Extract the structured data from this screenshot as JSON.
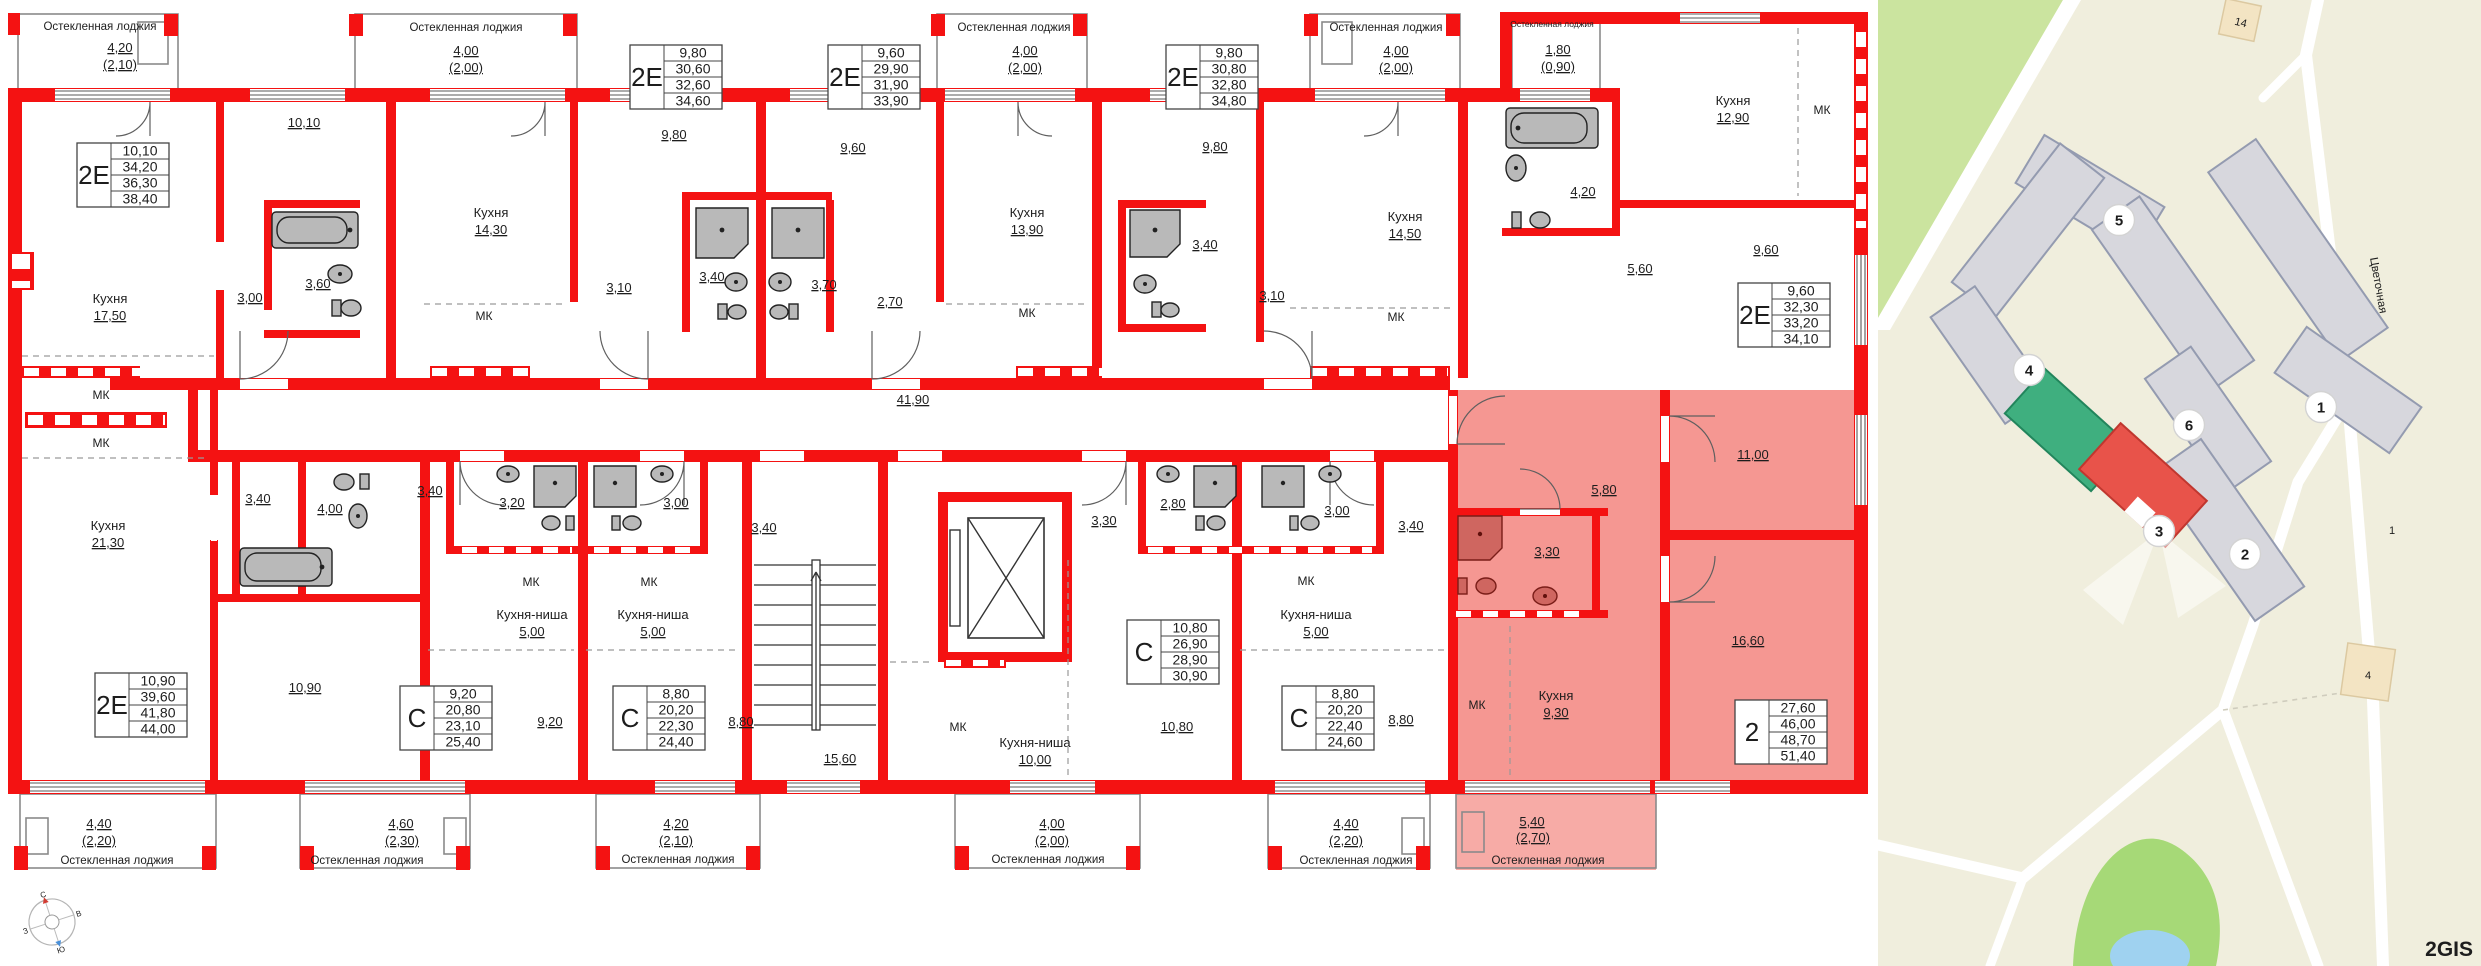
{
  "floor_plan": {
    "wall_color": "#f41212",
    "highlight_color": "#f59792",
    "corridor_area": "41,90",
    "labels": [
      [
        "Остекленная лоджия",
        100,
        30,
        11.5,
        ""
      ],
      [
        "4,20",
        120,
        52,
        13,
        "u"
      ],
      [
        "(2,10)",
        120,
        69,
        13,
        "u"
      ],
      [
        "Остекленная лоджия",
        466,
        31,
        11.5,
        ""
      ],
      [
        "4,00",
        466,
        55,
        13,
        "u"
      ],
      [
        "(2,00)",
        466,
        72,
        13,
        "u"
      ],
      [
        "Остекленная лоджия",
        1014,
        31,
        11.5,
        ""
      ],
      [
        "4,00",
        1025,
        55,
        13,
        "u"
      ],
      [
        "(2,00)",
        1025,
        72,
        13,
        "u"
      ],
      [
        "Остекленная лоджия",
        1386,
        31,
        11.5,
        ""
      ],
      [
        "4,00",
        1396,
        55,
        13,
        "u"
      ],
      [
        "(2,00)",
        1396,
        72,
        13,
        "u"
      ],
      [
        "Остекленная лоджия",
        1552,
        27,
        8.5,
        ""
      ],
      [
        "1,80",
        1558,
        54,
        13,
        "u"
      ],
      [
        "(0,90)",
        1558,
        71,
        13,
        "u"
      ],
      [
        "10,10",
        304,
        127,
        13,
        "u"
      ],
      [
        "Кухня",
        110,
        303,
        13,
        ""
      ],
      [
        "17,50",
        110,
        320,
        13,
        "u"
      ],
      [
        "3,00",
        250,
        302,
        13,
        "u"
      ],
      [
        "3,60",
        318,
        288,
        13,
        "u"
      ],
      [
        "9,80",
        674,
        139,
        13,
        "u"
      ],
      [
        "Кухня",
        491,
        217,
        13,
        ""
      ],
      [
        "14,30",
        491,
        234,
        13,
        "u"
      ],
      [
        "3,10",
        619,
        292,
        13,
        "u"
      ],
      [
        "3,40",
        712,
        281,
        13,
        "u"
      ],
      [
        "МК",
        484,
        320,
        12,
        ""
      ],
      [
        "9,60",
        853,
        152,
        13,
        "u"
      ],
      [
        "Кухня",
        1027,
        217,
        13,
        ""
      ],
      [
        "13,90",
        1027,
        234,
        13,
        "u"
      ],
      [
        "2,70",
        890,
        306,
        13,
        "u"
      ],
      [
        "3,70",
        824,
        289,
        13,
        "u"
      ],
      [
        "МК",
        1027,
        317,
        12,
        ""
      ],
      [
        "9,80",
        1215,
        151,
        13,
        "u"
      ],
      [
        "Кухня",
        1405,
        221,
        13,
        ""
      ],
      [
        "14,50",
        1405,
        238,
        13,
        "u"
      ],
      [
        "3,10",
        1272,
        300,
        13,
        "u"
      ],
      [
        "3,40",
        1205,
        249,
        13,
        "u"
      ],
      [
        "МК",
        1396,
        321,
        12,
        ""
      ],
      [
        "Кухня",
        1733,
        105,
        13,
        ""
      ],
      [
        "12,90",
        1733,
        122,
        13,
        "u"
      ],
      [
        "МК",
        1822,
        114,
        12,
        ""
      ],
      [
        "4,20",
        1583,
        196,
        13,
        "u"
      ],
      [
        "5,60",
        1640,
        273,
        13,
        "u"
      ],
      [
        "9,60",
        1766,
        254,
        13,
        "u"
      ],
      [
        "41,90",
        913,
        404,
        13,
        "u"
      ],
      [
        "МК",
        101,
        399,
        12,
        ""
      ],
      [
        "МК",
        101,
        447,
        12,
        ""
      ],
      [
        "Кухня",
        108,
        530,
        13,
        ""
      ],
      [
        "21,30",
        108,
        547,
        13,
        "u"
      ],
      [
        "3,40",
        258,
        503,
        13,
        "u"
      ],
      [
        "4,00",
        330,
        513,
        13,
        "u"
      ],
      [
        "10,90",
        305,
        692,
        13,
        "u"
      ],
      [
        "3,40",
        430,
        495,
        13,
        "u"
      ],
      [
        "3,20",
        512,
        507,
        13,
        "u"
      ],
      [
        "МК",
        531,
        586,
        12,
        ""
      ],
      [
        "Кухня-ниша",
        532,
        619,
        13,
        ""
      ],
      [
        "5,00",
        532,
        636,
        13,
        "u"
      ],
      [
        "9,20",
        550,
        726,
        13,
        "u"
      ],
      [
        "3,00",
        676,
        507,
        13,
        "u"
      ],
      [
        "3,40",
        764,
        532,
        13,
        "u"
      ],
      [
        "МК",
        649,
        586,
        12,
        ""
      ],
      [
        "Кухня-ниша",
        653,
        619,
        13,
        ""
      ],
      [
        "5,00",
        653,
        636,
        13,
        "u"
      ],
      [
        "8,80",
        741,
        726,
        13,
        "u"
      ],
      [
        "15,60",
        840,
        763,
        13,
        "u"
      ],
      [
        "3,30",
        1104,
        525,
        13,
        "u"
      ],
      [
        "2,80",
        1173,
        508,
        13,
        "u"
      ],
      [
        "МК",
        958,
        731,
        12,
        ""
      ],
      [
        "Кухня-ниша",
        1035,
        747,
        13,
        ""
      ],
      [
        "10,00",
        1035,
        764,
        13,
        "u"
      ],
      [
        "10,80",
        1177,
        731,
        13,
        "u"
      ],
      [
        "3,00",
        1337,
        515,
        13,
        "u"
      ],
      [
        "3,40",
        1411,
        530,
        13,
        "u"
      ],
      [
        "МК",
        1306,
        585,
        12,
        ""
      ],
      [
        "Кухня-ниша",
        1316,
        619,
        13,
        ""
      ],
      [
        "5,00",
        1316,
        636,
        13,
        "u"
      ],
      [
        "8,80",
        1401,
        724,
        13,
        "u"
      ],
      [
        "5,80",
        1604,
        494,
        13,
        "u"
      ],
      [
        "3,30",
        1547,
        556,
        13,
        "u"
      ],
      [
        "МК",
        1477,
        709,
        12,
        ""
      ],
      [
        "Кухня",
        1556,
        700,
        13,
        ""
      ],
      [
        "9,30",
        1556,
        717,
        13,
        "u"
      ],
      [
        "11,00",
        1753,
        459,
        13,
        "u"
      ],
      [
        "16,60",
        1748,
        645,
        13,
        "u"
      ],
      [
        "4,40",
        99,
        828,
        13,
        "u"
      ],
      [
        "(2,20)",
        99,
        845,
        13,
        "u"
      ],
      [
        "Остекленная лоджия",
        117,
        864,
        11.5,
        ""
      ],
      [
        "4,60",
        401,
        828,
        13,
        "u"
      ],
      [
        "(2,30)",
        402,
        845,
        13,
        "u"
      ],
      [
        "Остекленная лоджия",
        367,
        864,
        11.5,
        ""
      ],
      [
        "4,20",
        676,
        828,
        13,
        "u"
      ],
      [
        "(2,10)",
        676,
        845,
        13,
        "u"
      ],
      [
        "Остекленная лоджия",
        678,
        863,
        11.5,
        ""
      ],
      [
        "4,00",
        1052,
        828,
        13,
        "u"
      ],
      [
        "(2,00)",
        1052,
        845,
        13,
        "u"
      ],
      [
        "Остекленная лоджия",
        1048,
        863,
        11.5,
        ""
      ],
      [
        "4,40",
        1346,
        828,
        13,
        "u"
      ],
      [
        "(2,20)",
        1346,
        845,
        13,
        "u"
      ],
      [
        "Остекленная лоджия",
        1356,
        864,
        11.5,
        ""
      ],
      [
        "5,40",
        1532,
        826,
        13,
        "u",
        "#8d2420"
      ],
      [
        "(2,70)",
        1533,
        842,
        13,
        "u",
        "#8d2420"
      ],
      [
        "Остекленная лоджия",
        1548,
        864,
        11.5,
        "",
        "#a33a33"
      ]
    ],
    "tables": [
      {
        "t": "2Е",
        "x": 77,
        "y": 143,
        "v": [
          "10,10",
          "34,20",
          "36,30",
          "38,40"
        ]
      },
      {
        "t": "2Е",
        "x": 630,
        "y": 45,
        "v": [
          "9,80",
          "30,60",
          "32,60",
          "34,60"
        ]
      },
      {
        "t": "2Е",
        "x": 828,
        "y": 45,
        "v": [
          "9,60",
          "29,90",
          "31,90",
          "33,90"
        ]
      },
      {
        "t": "2Е",
        "x": 1166,
        "y": 45,
        "v": [
          "9,80",
          "30,80",
          "32,80",
          "34,80"
        ]
      },
      {
        "t": "2Е",
        "x": 1738,
        "y": 283,
        "v": [
          "9,60",
          "32,30",
          "33,20",
          "34,10"
        ]
      },
      {
        "t": "2Е",
        "x": 95,
        "y": 673,
        "v": [
          "10,90",
          "39,60",
          "41,80",
          "44,00"
        ]
      },
      {
        "t": "С",
        "x": 400,
        "y": 686,
        "v": [
          "9,20",
          "20,80",
          "23,10",
          "25,40"
        ]
      },
      {
        "t": "С",
        "x": 613,
        "y": 686,
        "v": [
          "8,80",
          "20,20",
          "22,30",
          "24,40"
        ]
      },
      {
        "t": "С",
        "x": 1127,
        "y": 620,
        "v": [
          "10,80",
          "26,90",
          "28,90",
          "30,90"
        ]
      },
      {
        "t": "С",
        "x": 1282,
        "y": 686,
        "v": [
          "8,80",
          "20,20",
          "22,40",
          "24,60"
        ]
      },
      {
        "t": "2",
        "x": 1735,
        "y": 700,
        "v": [
          "27,60",
          "46,00",
          "48,70",
          "51,40"
        ]
      }
    ],
    "compass": {
      "n": "С",
      "e": "В",
      "s": "Ю",
      "w": "З"
    }
  },
  "map": {
    "street": "Цветочная",
    "watermark": "2GIS",
    "markers": [
      [
        "5",
        241,
        220
      ],
      [
        "4",
        151,
        370
      ],
      [
        "6",
        311,
        425
      ],
      [
        "1",
        443,
        407
      ],
      [
        "2",
        367,
        554
      ],
      [
        "3",
        281,
        531
      ]
    ],
    "building_labels": [
      [
        "14",
        362,
        22,
        14
      ],
      [
        "4",
        490,
        675,
        0
      ],
      [
        "1",
        514,
        530,
        0
      ]
    ],
    "selected_building_color": "#e8534a",
    "second_building_color": "#3faf7f"
  }
}
